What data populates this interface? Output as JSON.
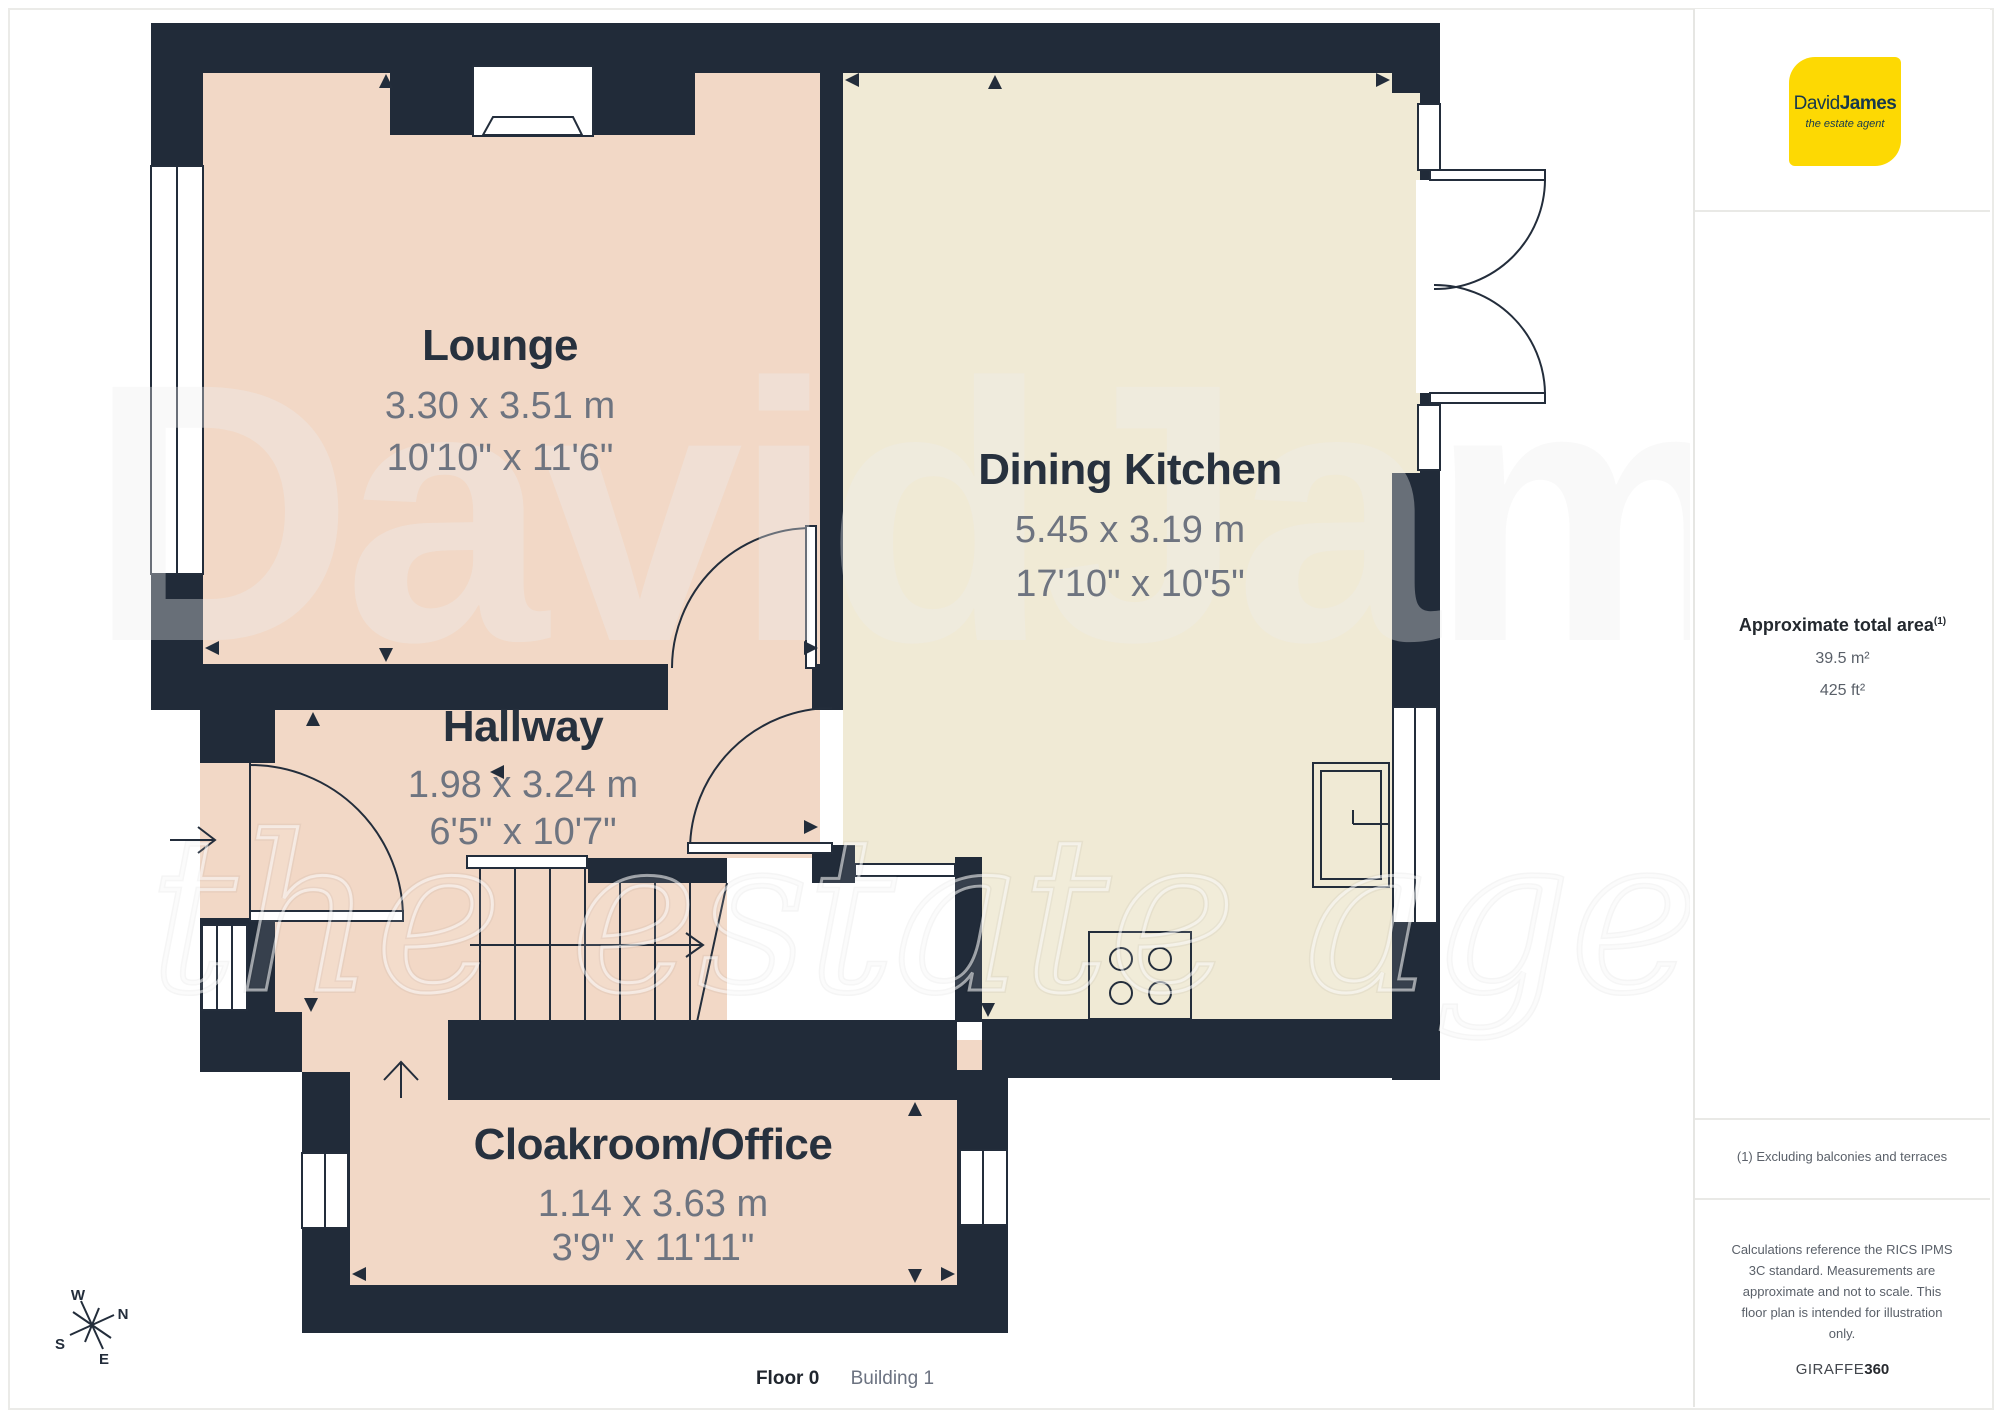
{
  "plan": {
    "rooms": [
      {
        "name": "Lounge",
        "metric": "3.30 x 3.51 m",
        "imperial": "10'10\" x 11'6\""
      },
      {
        "name": "Dining Kitchen",
        "metric": "5.45 x 3.19 m",
        "imperial": "17'10\" x 10'5\""
      },
      {
        "name": "Hallway",
        "metric": "1.98 x 3.24 m",
        "imperial": "6'5\" x 10'7\""
      },
      {
        "name": "Cloakroom/Office",
        "metric": "1.14 x 3.63 m",
        "imperial": "3'9\" x 11'11\""
      }
    ],
    "compass": {
      "n": "N",
      "s": "S",
      "e": "E",
      "w": "W"
    },
    "watermark": {
      "line1": "DavidJames",
      "line2": "the estate agent"
    },
    "caption": {
      "floor": "Floor 0",
      "building": "Building 1"
    }
  },
  "sidebar": {
    "logo": {
      "name_regular": "David",
      "name_bold": "James",
      "tagline": "the estate agent"
    },
    "area": {
      "title": "Approximate total area",
      "title_sup": "(1)",
      "metric": "39.5 m²",
      "imperial": "425 ft²"
    },
    "note": "(1) Excluding balconies and terraces",
    "disclaimer": "Calculations reference the RICS IPMS\n3C standard. Measurements are\napproximate and not to scale. This\nfloor plan is intended for illustration\nonly.",
    "brand": {
      "giraffe": "GIRAFFE",
      "n360": "360"
    }
  },
  "colors": {
    "wall": "#212b39",
    "floor_pink": "#f2d8c6",
    "floor_cream": "#f0ead5",
    "brand_yellow": "#fdd903",
    "logo_text": "#16384e",
    "text_dark": "#27313e",
    "text_dim": "#6e7480"
  }
}
